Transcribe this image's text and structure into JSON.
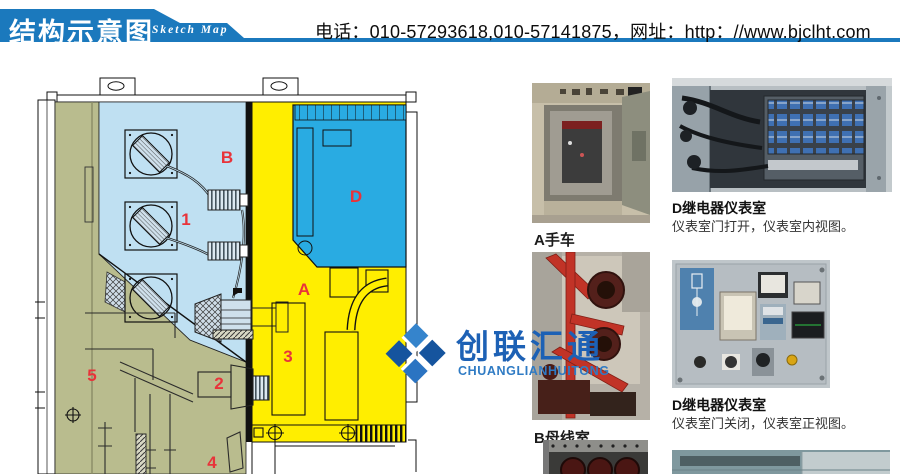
{
  "header": {
    "title_cn": "结构示意图",
    "title_en": "Sketch Map",
    "contact": "电话：010-57293618,010-57141875，网址：http：//www.bjclht.com",
    "banner_color": "#1b79bd"
  },
  "watermark": {
    "name_cn": "创联汇通",
    "name_en": "CHUANGLIANHUITONG",
    "color": "#1d61b5"
  },
  "diagram": {
    "labels": [
      {
        "id": "B",
        "text": "B"
      },
      {
        "id": "1",
        "text": "1"
      },
      {
        "id": "D",
        "text": "D"
      },
      {
        "id": "A",
        "text": "A"
      },
      {
        "id": "3",
        "text": "3"
      },
      {
        "id": "2",
        "text": "2"
      },
      {
        "id": "5",
        "text": "5"
      },
      {
        "id": "4",
        "text": "4"
      }
    ],
    "colors": {
      "busbar_compartment": "#bfe0f2",
      "relay_compartment": "#29abe2",
      "breaker_compartment": "#ffee00",
      "cable_compartment": "#b9bc8e",
      "label_red": "#e8333a"
    }
  },
  "photos": {
    "a": {
      "caption": "A手车"
    },
    "d_open": {
      "title": "D继电器仪表室",
      "desc": "仪表室门打开，仪表室内视图。"
    },
    "b": {
      "caption": "B母线室"
    },
    "d_closed": {
      "title": "D继电器仪表室",
      "desc": "仪表室门关闭，仪表室正视图。"
    }
  }
}
